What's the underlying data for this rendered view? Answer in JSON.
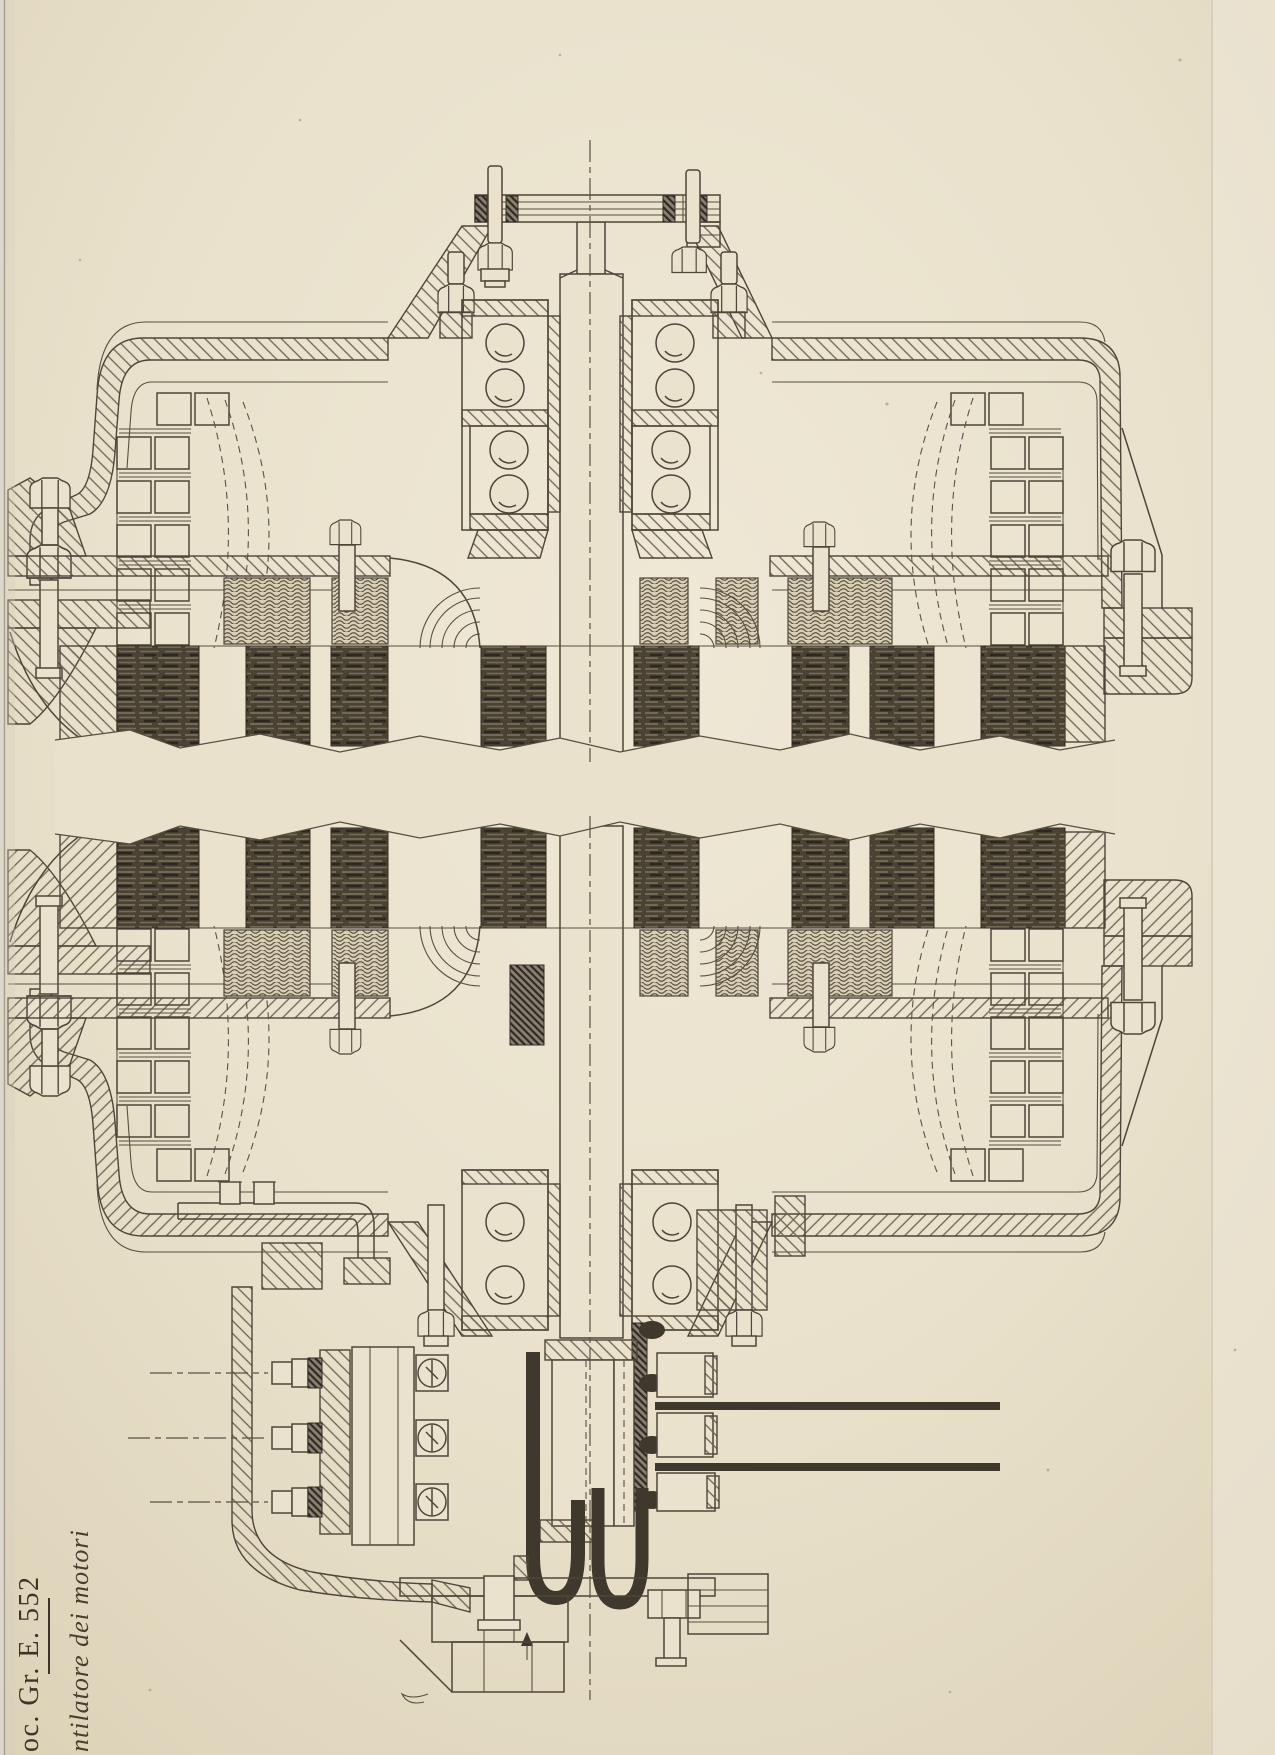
{
  "page": {
    "paper_color": "#e9e1cb",
    "ink_color": "#4d4639",
    "dark_fill": "#3e382d"
  },
  "margin_labels": {
    "reference": "oc. Gr. E. 552",
    "caption": "ntilatore dei motori"
  }
}
